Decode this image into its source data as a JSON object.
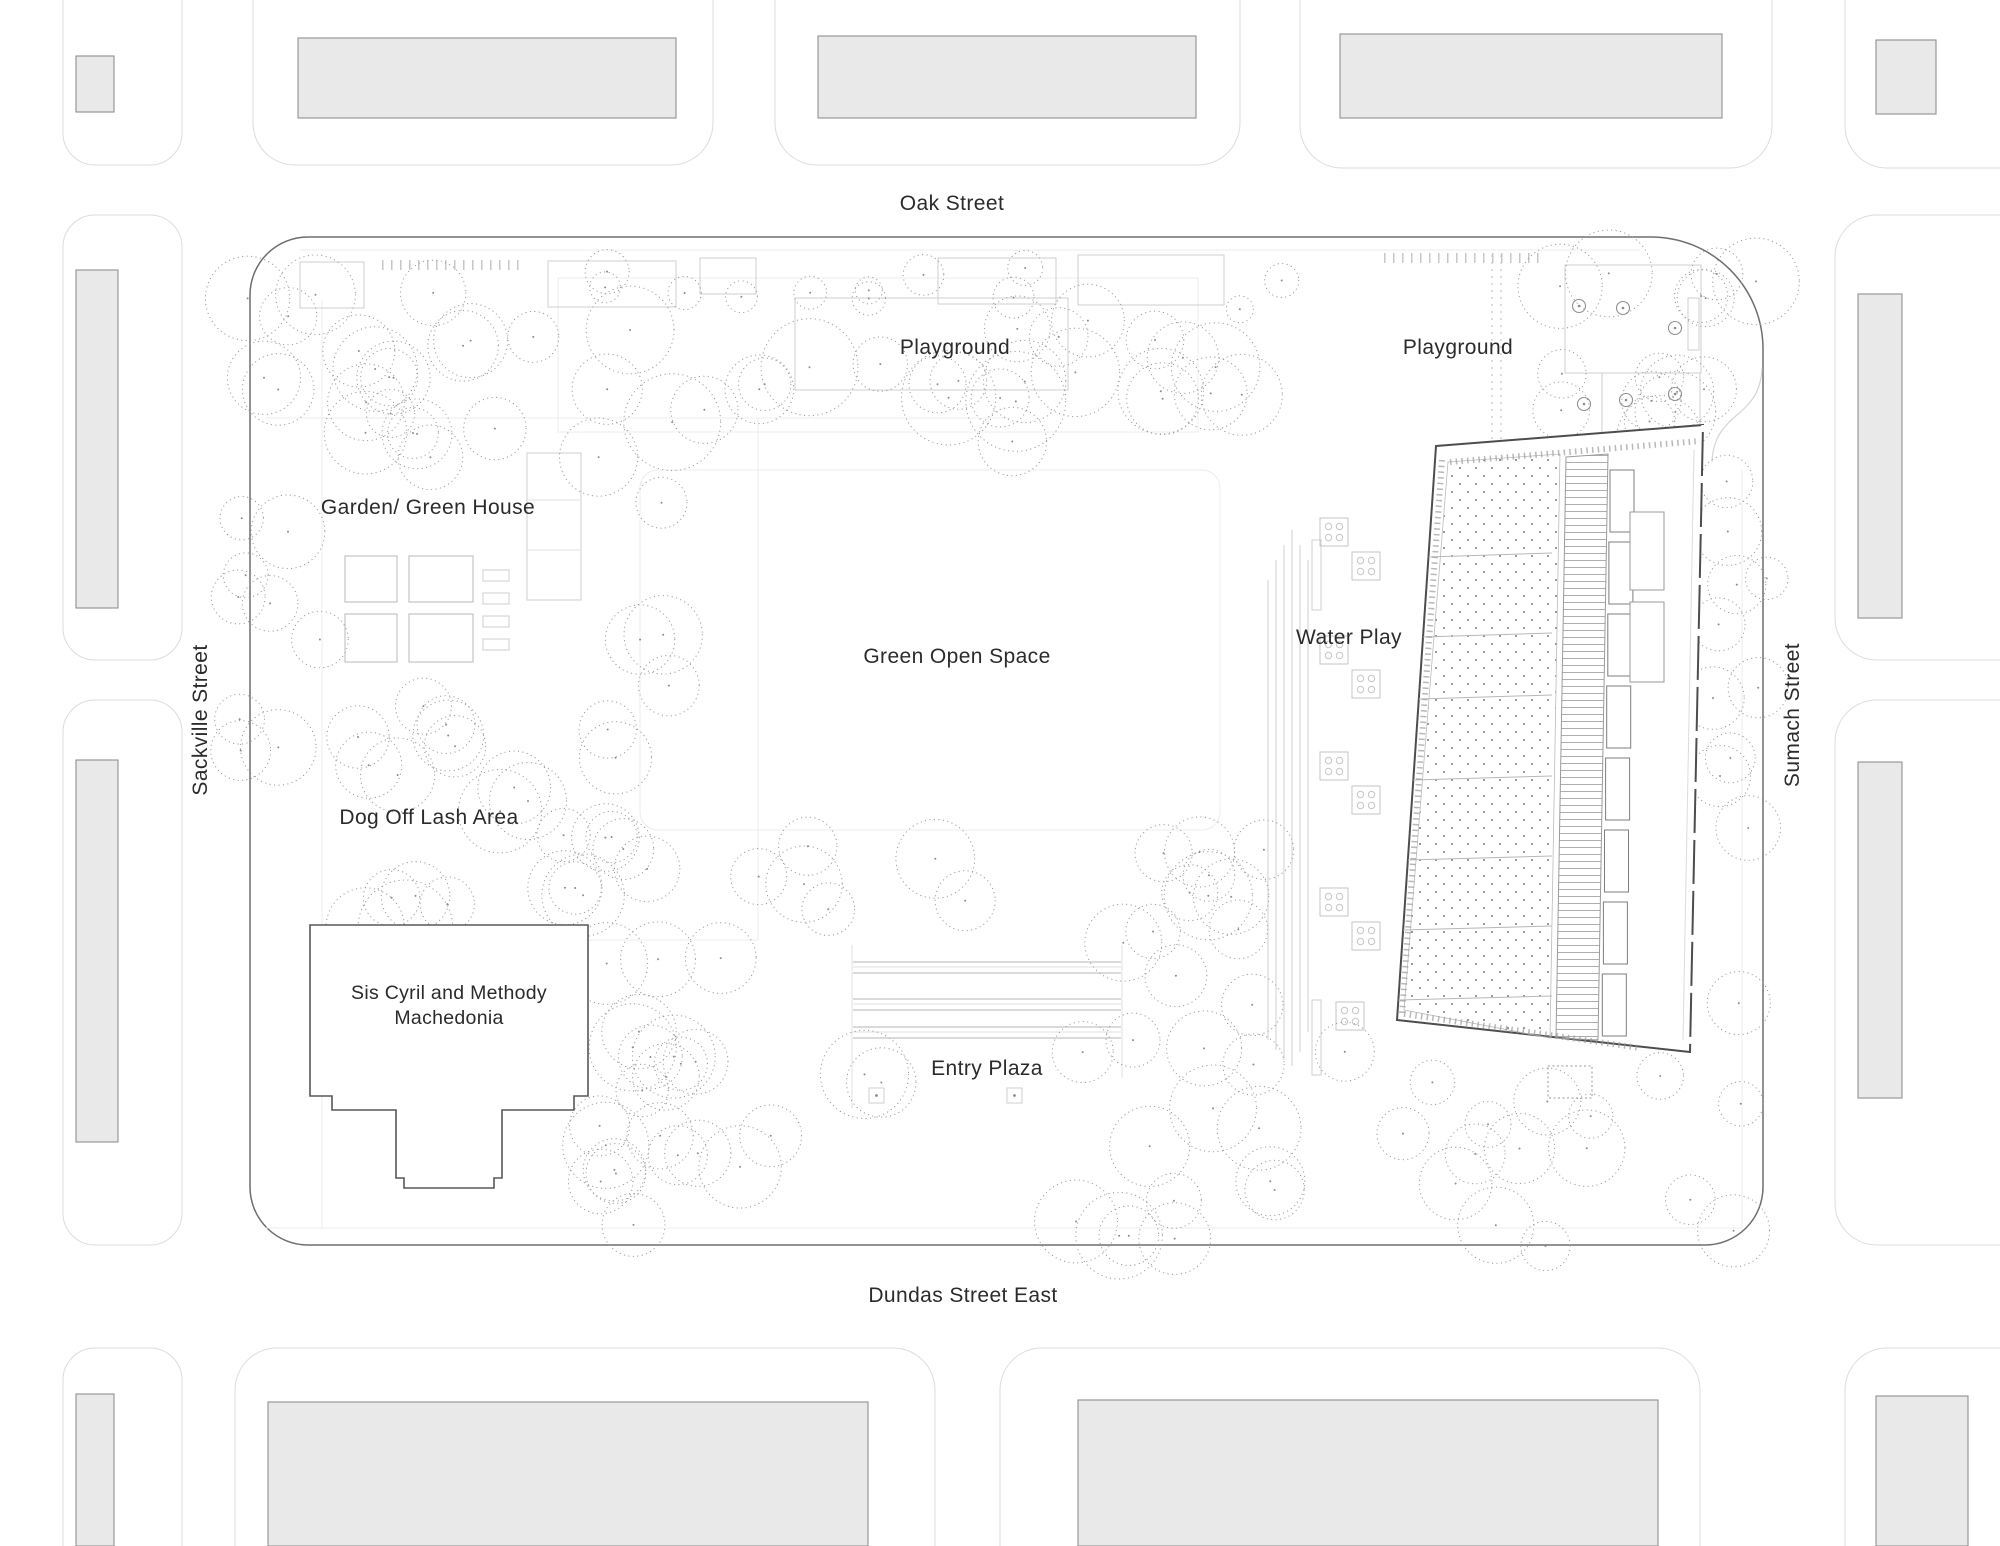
{
  "plan": {
    "streets": {
      "north": "Oak Street",
      "south": "Dundas Street East",
      "west": "Sackville Street",
      "east": "Sumach Street"
    },
    "labels": {
      "playground_left": "Playground",
      "playground_right": "Playground",
      "garden_greenhouse": "Garden/ Green House",
      "green_open_space": "Green Open Space",
      "water_play": "Water Play",
      "dog_off_leash": "Dog Off Lash Area",
      "church_line1": "Sis Cyril and Methody",
      "church_line2": "Machedonia",
      "entry_plaza": "Entry Plaza"
    },
    "colors": {
      "background": "#ffffff",
      "site_outline": "#6e6e6e",
      "context_block_outline": "#dcdcdc",
      "context_building_fill": "#e9e9e9",
      "tree_stroke": "#9b9b9b",
      "detail_light": "#cfcfcf",
      "pool_building_stroke": "#4d4d4d",
      "label_color": "#2b2b2b"
    }
  }
}
